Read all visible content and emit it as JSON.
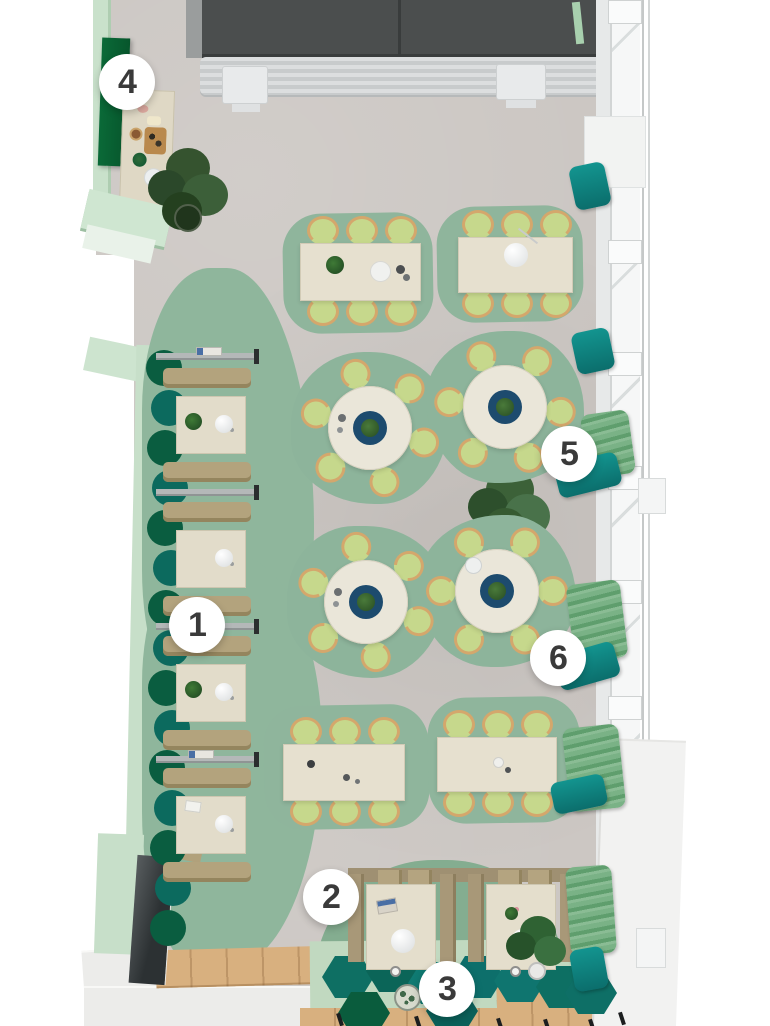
{
  "scene": {
    "kind": "restaurant interior floor plan, 3D top-down render",
    "annotation_style": "numbered white circular markers"
  },
  "markers": [
    {
      "label": "1"
    },
    {
      "label": "2"
    },
    {
      "label": "3"
    },
    {
      "label": "4"
    },
    {
      "label": "5"
    },
    {
      "label": "6"
    }
  ],
  "palette": {
    "floor_concrete": "#cbc6c2",
    "area_rug_green": "#8db49b",
    "wall_mint": "#c9e1cb",
    "accent_emerald": "#0a6138",
    "accent_teal": "#0e807d",
    "curtain_green": "#74ae80",
    "chair_green": "#c6d88c",
    "wood_tan": "#d4a76c",
    "table_cream": "#e6e0cf",
    "lazy_susan_navy": "#1d4b6e",
    "booth_khaki": "#b3a37d",
    "entry_dark": "#4b4e4e",
    "marker_bg": "#ffffff",
    "marker_text": "#3a3a3a"
  }
}
